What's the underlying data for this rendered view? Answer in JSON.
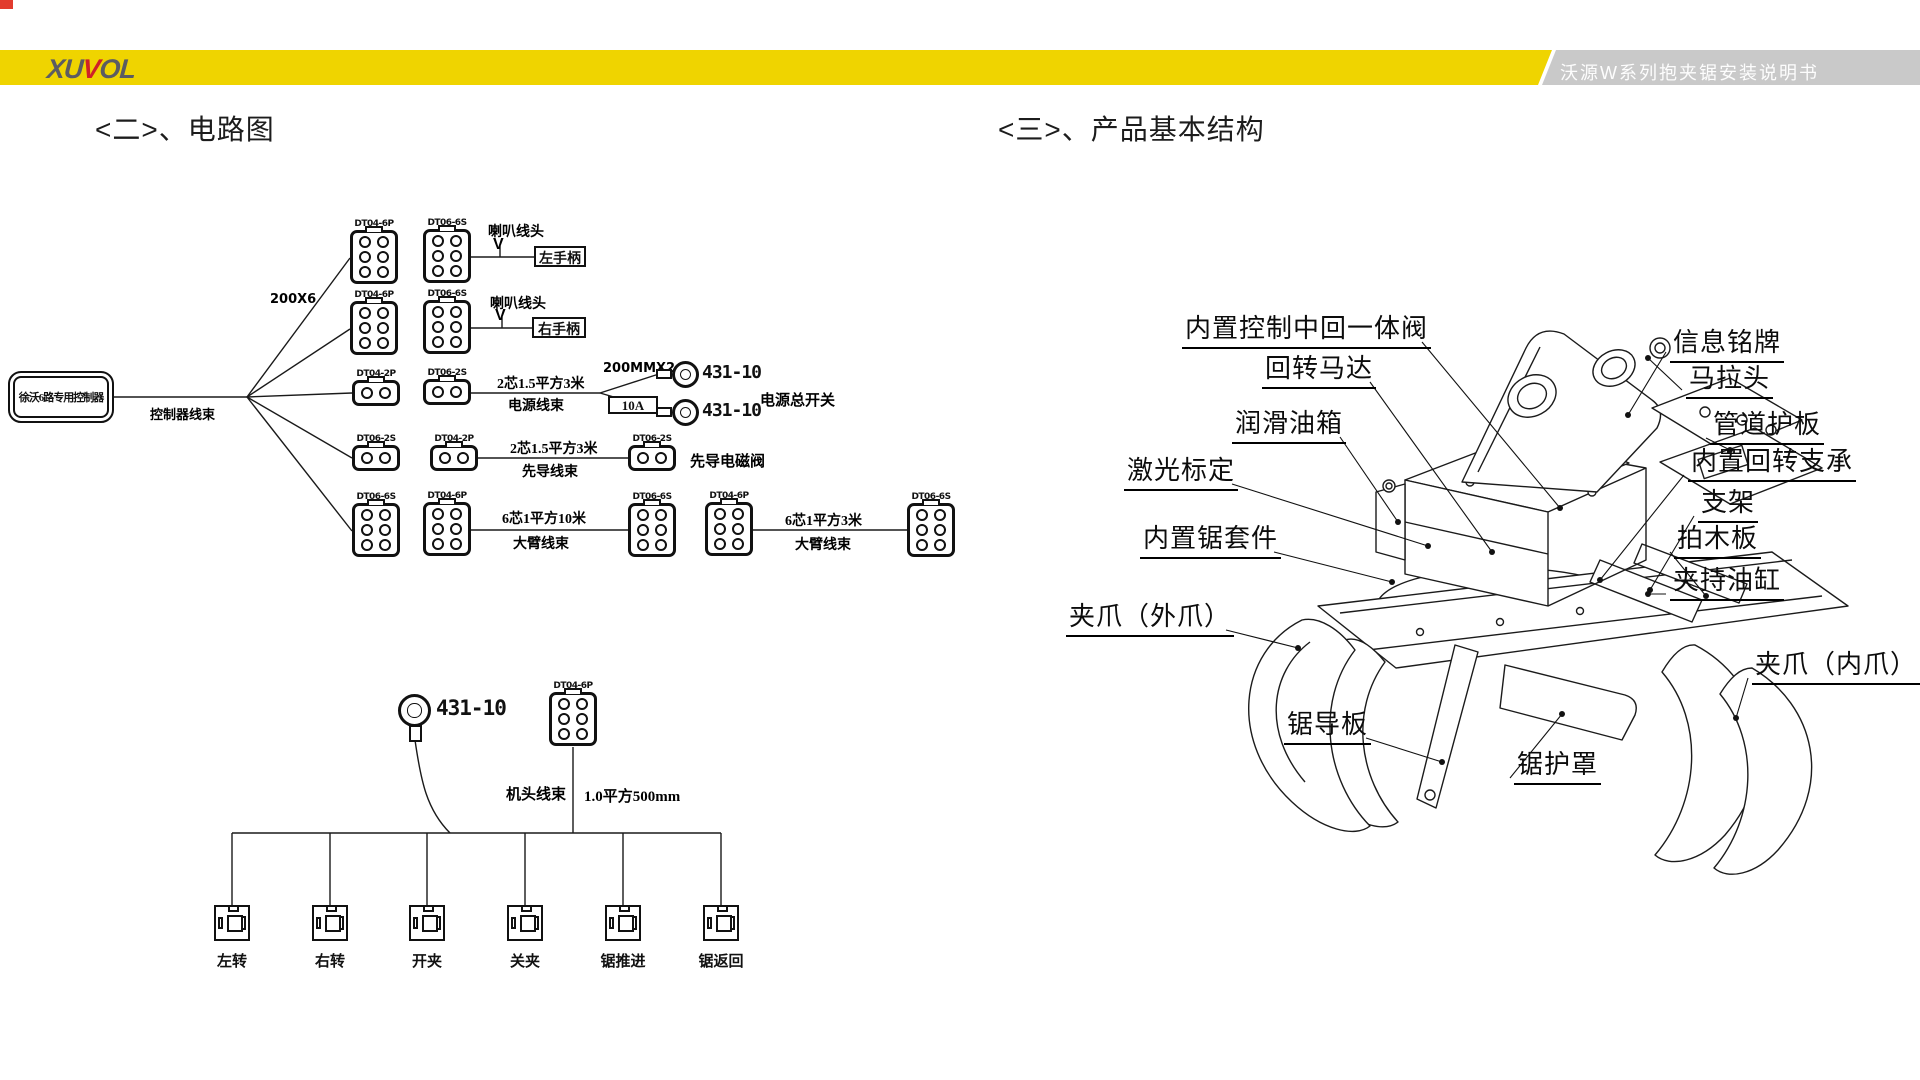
{
  "colors": {
    "yellow": "#efd400",
    "gray_band": "#c9c9c9",
    "logo_gray": "#5c5c62",
    "logo_red": "#cf2128",
    "corner_red": "#e23b2e",
    "line": "#1a1a1a"
  },
  "header": {
    "logo_xu": "XU",
    "logo_v": "V",
    "logo_ol": "OL",
    "doc_title": "沃源W系列抱夹锯安装说明书"
  },
  "sections": {
    "circuit_title": "<二>、电路图",
    "structure_title": "<三>、产品基本结构"
  },
  "circuit": {
    "controller_label": "徐沃6路专用控制器",
    "controller_harness": "控制器线束",
    "fanout": "200X6",
    "row1": {
      "c1": "DT04-6P",
      "c2": "DT06-6S",
      "wire": "喇叭线头",
      "v": "V",
      "target": "左手柄"
    },
    "row2": {
      "c1": "DT04-6P",
      "c2": "DT06-6S",
      "wire": "喇叭线头",
      "v": "V",
      "target": "右手柄"
    },
    "row3": {
      "c1": "DT04-2P",
      "c2": "DT06-2S",
      "wire1": "2芯1.5平方3米",
      "wire2": "电源线束",
      "branch": "200MMX2",
      "t1": "431-10",
      "fuse": "10A",
      "t2": "431-10",
      "target": "电源总开关"
    },
    "row4": {
      "c1": "DT06-2S",
      "c2": "DT04-2P",
      "wire1": "2芯1.5平方3米",
      "wire2": "先导线束",
      "c3": "DT06-2S",
      "target": "先导电磁阀"
    },
    "row5": {
      "c1": "DT06-6S",
      "c2": "DT04-6P",
      "wireA1": "6芯1平方10米",
      "wireA2": "大臂线束",
      "c3": "DT06-6S",
      "c4": "DT04-6P",
      "wireB1": "6芯1平方3米",
      "wireB2": "大臂线束",
      "c5": "DT06-6S"
    },
    "head": {
      "terminal": "431-10",
      "conn": "DT04-6P",
      "harness": "机头线束",
      "spec": "1.0平方500mm",
      "switches": [
        "左转",
        "右转",
        "开夹",
        "关夹",
        "锯推进",
        "锯返回"
      ]
    }
  },
  "structure": {
    "labels_left": [
      "内置控制中回一体阀",
      "回转马达",
      "润滑油箱",
      "激光标定",
      "内置锯套件",
      "夹爪（外爪）",
      "锯导板"
    ],
    "labels_right": [
      "信息铭牌",
      "马拉头",
      "管道护板",
      "内置回转支承",
      "支架",
      "拍木板",
      "夹持油缸",
      "夹爪（内爪）",
      "锯护罩"
    ]
  }
}
